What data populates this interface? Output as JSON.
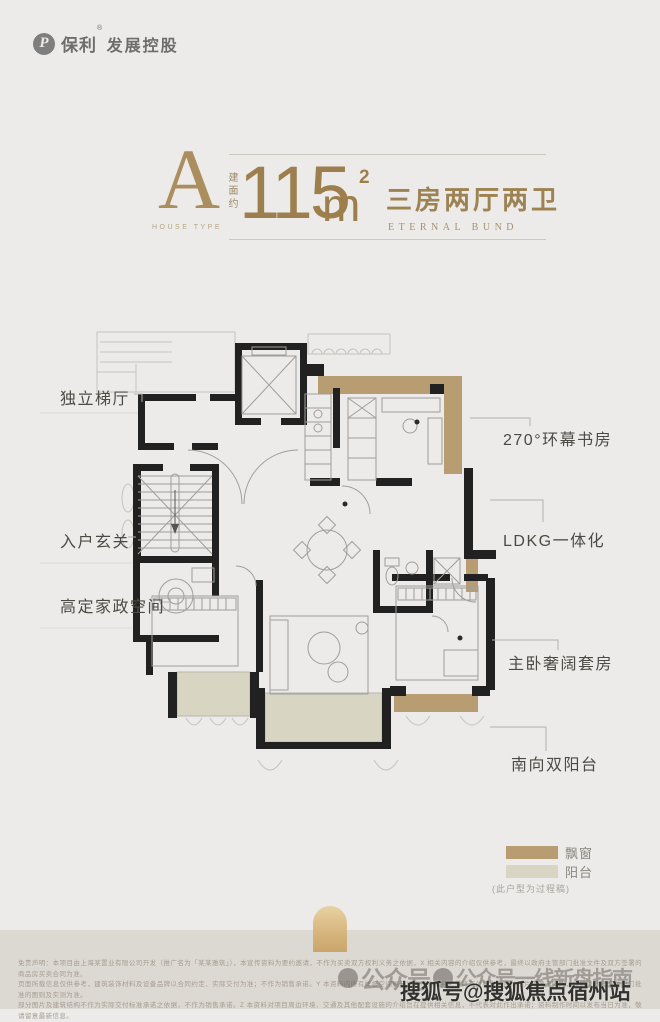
{
  "page": {
    "bg": "#ecebe9",
    "band_bg": "#dcd9d3",
    "width": 660,
    "height": 1009
  },
  "brand": {
    "logo_letter": "P",
    "name": "保利",
    "reg": "®",
    "suffix": "发展控股"
  },
  "title": {
    "type_letter": "A",
    "type_caption": "HOUSE TYPE",
    "area_prefix": "建面约",
    "area_value": "115",
    "area_unit": "m",
    "area_exp": "2",
    "rooms": "三房两厅两卫",
    "subtitle": "ETERNAL BUND",
    "accent": "#9d7f4e"
  },
  "plan": {
    "labels_left": [
      {
        "text": "独立梯厅"
      },
      {
        "text": "入户玄关"
      },
      {
        "text": "高定家政空间"
      }
    ],
    "labels_right": [
      {
        "text": "270°环幕书房"
      },
      {
        "text": "LDKG一体化"
      },
      {
        "text": "主卧奢阔套房"
      },
      {
        "text": "南向双阳台"
      }
    ],
    "colors": {
      "wall": "#212121",
      "bay_window": "#b89d72",
      "balcony": "#d9d5c3",
      "furniture": "#a09e9a",
      "leader": "#b3b0aa"
    }
  },
  "legend": {
    "items": [
      {
        "label": "飘窗",
        "color": "#b89d72"
      },
      {
        "label": "阳台",
        "color": "#d9d5c3"
      }
    ],
    "note": "(此户型为过程稿)"
  },
  "decor": {
    "arch_top": "#e8d2a2",
    "arch_bottom": "#c9a56c"
  },
  "watermarks": {
    "gray_prefix": "公众号",
    "gray_suffix": "公众号一线新盘指南",
    "bold": "搜狐号@搜狐焦点宿州站"
  },
  "fine_print": {
    "lines": [
      "免责声明：本项目由上海某置业有限公司开发（推广名为「某某雅筑」），本宣传资料为要约邀请，不作为买卖双方权利义务之依据，X 相关内容的介绍仅供参考，最终以政府主管部门批准文件及双方签署的商品房买卖合同为准。",
      "页面所载信息仅供参考，建筑装饰材料及设备品牌以合同约定、实际交付为准；不作为销售承诺。Y 本资料内所有样板空间展示均为示意，并非最终交付标准，部分图片来源于网络，最终以政府有关部门批准的图则及实测为准。",
      "部分图片及建筑结构不作为实际交付标准承诺之依据，不作为销售承诺。Z 本资料对项目周边环境、交通及其他配套设施的介绍旨在提供相关信息，不代表对此作出承诺；资料制作时间以发布当日为准，敬请留意最新信息。"
    ]
  }
}
